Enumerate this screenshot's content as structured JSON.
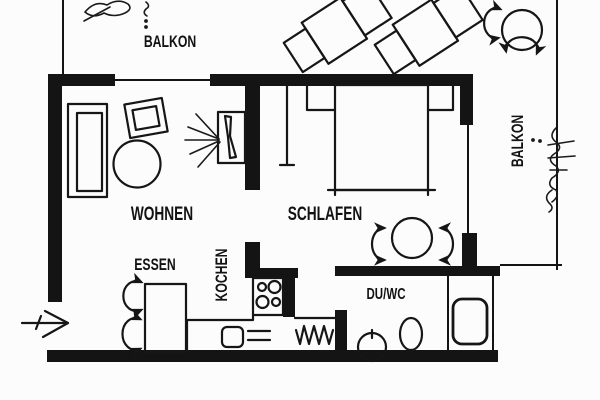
{
  "plan": {
    "title": "apartment-floor-plan",
    "rooms": {
      "balcony_top": {
        "label": "BALKON"
      },
      "balcony_right": {
        "label": "BALKON"
      },
      "living": {
        "label": "WOHNEN"
      },
      "sleeping": {
        "label": "SCHLAFEN"
      },
      "dining": {
        "label": "ESSEN"
      },
      "kitchen": {
        "label": "KOCHEN"
      },
      "bath": {
        "label": "DU/WC"
      }
    },
    "colors": {
      "ink": "#141414",
      "paper": "#fcfcfc"
    },
    "symbols": [
      "sofa",
      "armchair",
      "coffee-table",
      "tv",
      "tv-light-rays",
      "dining-table",
      "chair-arc",
      "kitchen-counter",
      "kitchen-sink",
      "stove-burners",
      "radiator",
      "bed",
      "nightstand",
      "wardrobe",
      "round-table",
      "shower",
      "toilet",
      "washbasin",
      "lounge-chair",
      "balcony-table",
      "plant",
      "entrance-arrow",
      "window-line",
      "balcony-railing"
    ]
  }
}
